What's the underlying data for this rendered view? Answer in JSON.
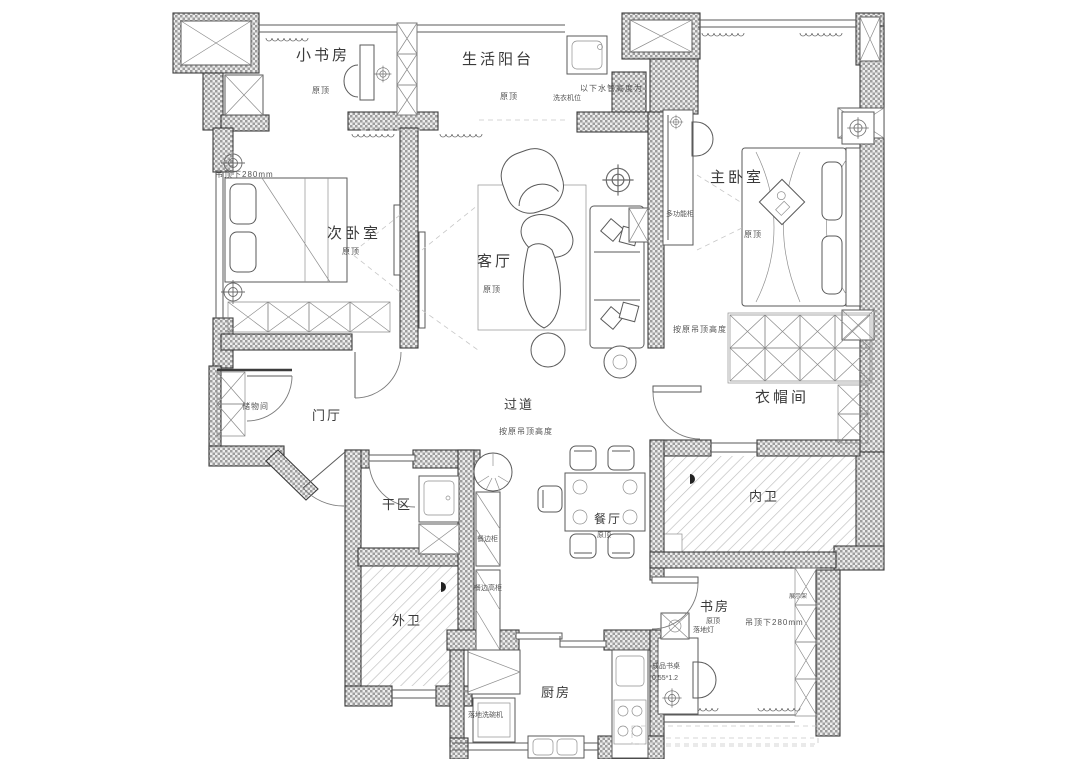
{
  "rooms": {
    "small_study": {
      "name": "小书房",
      "ceiling": "原顶"
    },
    "balcony": {
      "name": "生活阳台",
      "ceiling": "原顶"
    },
    "second_bedroom": {
      "name": "次卧室",
      "ceiling": "原顶",
      "drop": "吊顶下280mm"
    },
    "living": {
      "name": "客厅",
      "ceiling": "原顶"
    },
    "master_bedroom": {
      "name": "主卧室",
      "ceiling": "原顶"
    },
    "cloakroom": {
      "name": "衣帽间",
      "note": "按原吊顶高度"
    },
    "foyer": {
      "name": "门厅"
    },
    "hallway": {
      "name": "过道",
      "note": "按原吊顶高度"
    },
    "storage": {
      "name": "储物间"
    },
    "dry_area": {
      "name": "干区"
    },
    "outer_bath": {
      "name": "外卫"
    },
    "dining": {
      "name": "餐厅",
      "ceiling": "原顶"
    },
    "inner_bath": {
      "name": "内卫"
    },
    "study": {
      "name": "书房",
      "ceiling": "原顶",
      "drop": "吊顶下280mm"
    },
    "kitchen": {
      "name": "厨房"
    }
  },
  "annotations": {
    "pipe_height": "以下水管高度为",
    "washer": "洗衣机位",
    "multi_cabinet": "多功能柜",
    "sideboard": "餐边柜",
    "sideboard_tall": "餐边高柜",
    "floor_lamp": "落地灯",
    "desk": "成品书桌",
    "desk_size": "0.55*1.2",
    "display_shelf": "展示架",
    "dishwasher": "落地洗碗机"
  },
  "colors": {
    "wall_hatch": "#9d9d9d",
    "line": "#3c3c3c",
    "text": "#3a3a3a"
  }
}
